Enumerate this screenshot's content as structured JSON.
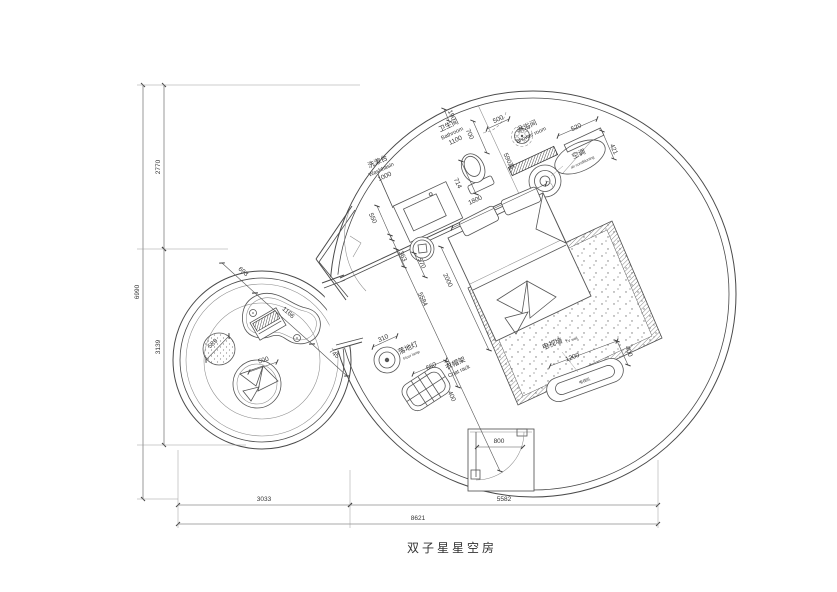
{
  "title": "双子星星空房",
  "labels": {
    "bathroom_cn": "卫生间",
    "bathroom_en": "Bathroom",
    "washbasin_cn": "洗漱台",
    "washbasin_en": "Washbasin",
    "shower_cn": "淋浴间",
    "shower_en": "Shower room",
    "ac_cn": "空调",
    "ac_en": "air conditioning",
    "floorlamp_cn": "落地灯",
    "floorlamp_en": "Floor lamp",
    "coatrack_cn": "衣帽架",
    "coatrack_en": "Coat rack",
    "tvwall_cn": "电视墙",
    "tvwall_en": "TV wall",
    "tv_cn": "电视机"
  },
  "dims": {
    "bathroom_w": "1100",
    "washbasin_w": "1000",
    "d190": "190",
    "d700": "700",
    "d500_shower": "500",
    "d590h": "590高",
    "d520": "520",
    "d421": "421",
    "d550": "550",
    "d714": "714",
    "bed_w": "1800",
    "bed_l": "2000",
    "d5584": "5584",
    "d363": "363",
    "d570": "570",
    "d310": "310",
    "d660": "660",
    "d400_rack": "400",
    "d1200": "1200",
    "d400_tv": "400",
    "d800": "800",
    "d693": "693",
    "d1166": "1166",
    "d745": "745",
    "d589": "589",
    "d500_bean": "500",
    "left_total": "6990",
    "left_top": "2770",
    "left_bottom": "3139",
    "bottom_left": "3033",
    "bottom_right": "5582",
    "bottom_total": "8621"
  }
}
